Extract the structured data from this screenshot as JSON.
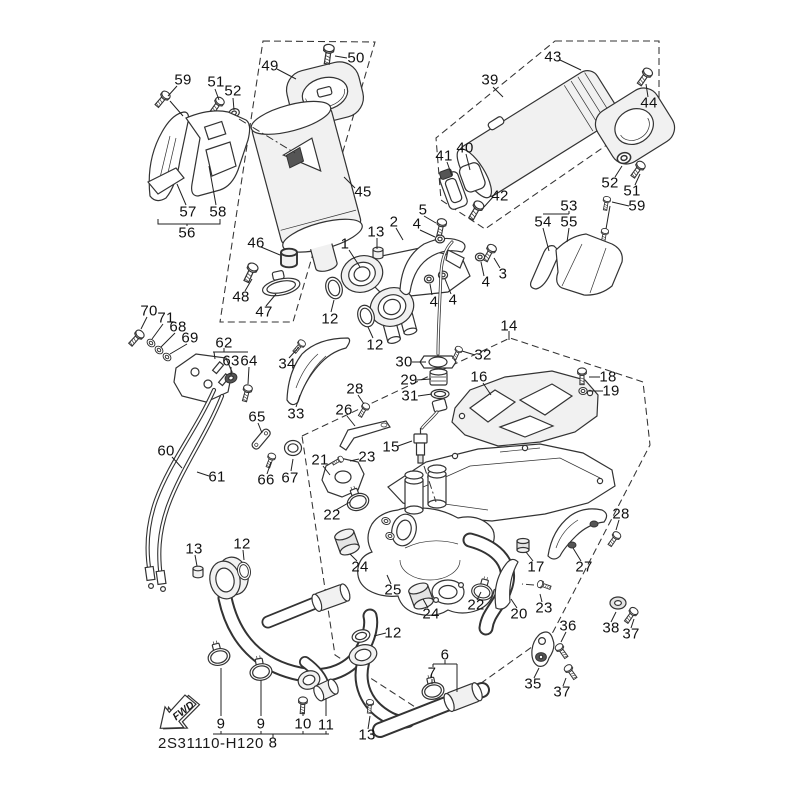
{
  "diagram": {
    "code": "2S31110-H120",
    "fwd_label": "FWD",
    "colors": {
      "line": "#333333",
      "background": "#ffffff",
      "text": "#111111"
    },
    "labels": [
      {
        "t": "59",
        "x": 183,
        "y": 80
      },
      {
        "t": "51",
        "x": 216,
        "y": 82
      },
      {
        "t": "52",
        "x": 233,
        "y": 91
      },
      {
        "t": "49",
        "x": 270,
        "y": 66
      },
      {
        "t": "50",
        "x": 356,
        "y": 58
      },
      {
        "t": "45",
        "x": 363,
        "y": 192
      },
      {
        "t": "57",
        "x": 188,
        "y": 212
      },
      {
        "t": "58",
        "x": 218,
        "y": 212
      },
      {
        "t": "56",
        "x": 187,
        "y": 233
      },
      {
        "t": "46",
        "x": 256,
        "y": 243
      },
      {
        "t": "48",
        "x": 241,
        "y": 297
      },
      {
        "t": "47",
        "x": 264,
        "y": 312
      },
      {
        "t": "43",
        "x": 553,
        "y": 57
      },
      {
        "t": "39",
        "x": 490,
        "y": 80
      },
      {
        "t": "44",
        "x": 649,
        "y": 103
      },
      {
        "t": "40",
        "x": 465,
        "y": 148
      },
      {
        "t": "41",
        "x": 444,
        "y": 156
      },
      {
        "t": "42",
        "x": 500,
        "y": 196
      },
      {
        "t": "52",
        "x": 610,
        "y": 183
      },
      {
        "t": "51",
        "x": 632,
        "y": 191
      },
      {
        "t": "59",
        "x": 637,
        "y": 206
      },
      {
        "t": "53",
        "x": 569,
        "y": 206
      },
      {
        "t": "54",
        "x": 543,
        "y": 222
      },
      {
        "t": "55",
        "x": 569,
        "y": 222
      },
      {
        "t": "1",
        "x": 345,
        "y": 244
      },
      {
        "t": "13",
        "x": 376,
        "y": 232
      },
      {
        "t": "2",
        "x": 394,
        "y": 222
      },
      {
        "t": "5",
        "x": 423,
        "y": 210
      },
      {
        "t": "4",
        "x": 417,
        "y": 224
      },
      {
        "t": "3",
        "x": 503,
        "y": 274
      },
      {
        "t": "4",
        "x": 486,
        "y": 282
      },
      {
        "t": "4",
        "x": 453,
        "y": 300
      },
      {
        "t": "4",
        "x": 434,
        "y": 302
      },
      {
        "t": "12",
        "x": 330,
        "y": 319
      },
      {
        "t": "12",
        "x": 375,
        "y": 345
      },
      {
        "t": "14",
        "x": 509,
        "y": 326
      },
      {
        "t": "70",
        "x": 149,
        "y": 311
      },
      {
        "t": "71",
        "x": 166,
        "y": 318
      },
      {
        "t": "68",
        "x": 178,
        "y": 327
      },
      {
        "t": "69",
        "x": 190,
        "y": 338
      },
      {
        "t": "62",
        "x": 224,
        "y": 343
      },
      {
        "t": "63",
        "x": 231,
        "y": 361
      },
      {
        "t": "64",
        "x": 249,
        "y": 361
      },
      {
        "t": "34",
        "x": 287,
        "y": 364
      },
      {
        "t": "33",
        "x": 296,
        "y": 414
      },
      {
        "t": "60",
        "x": 166,
        "y": 451
      },
      {
        "t": "61",
        "x": 217,
        "y": 477
      },
      {
        "t": "65",
        "x": 257,
        "y": 417
      },
      {
        "t": "66",
        "x": 266,
        "y": 480
      },
      {
        "t": "67",
        "x": 290,
        "y": 478
      },
      {
        "t": "30",
        "x": 404,
        "y": 362
      },
      {
        "t": "32",
        "x": 483,
        "y": 355
      },
      {
        "t": "29",
        "x": 409,
        "y": 380
      },
      {
        "t": "31",
        "x": 410,
        "y": 396
      },
      {
        "t": "16",
        "x": 479,
        "y": 377
      },
      {
        "t": "18",
        "x": 608,
        "y": 377
      },
      {
        "t": "19",
        "x": 611,
        "y": 391
      },
      {
        "t": "15",
        "x": 391,
        "y": 447
      },
      {
        "t": "26",
        "x": 344,
        "y": 410
      },
      {
        "t": "28",
        "x": 355,
        "y": 389
      },
      {
        "t": "23",
        "x": 367,
        "y": 457
      },
      {
        "t": "21",
        "x": 320,
        "y": 460
      },
      {
        "t": "22",
        "x": 332,
        "y": 515
      },
      {
        "t": "24",
        "x": 360,
        "y": 567
      },
      {
        "t": "25",
        "x": 393,
        "y": 590
      },
      {
        "t": "17",
        "x": 536,
        "y": 567
      },
      {
        "t": "27",
        "x": 584,
        "y": 567
      },
      {
        "t": "28",
        "x": 621,
        "y": 514
      },
      {
        "t": "13",
        "x": 194,
        "y": 549
      },
      {
        "t": "12",
        "x": 242,
        "y": 544
      },
      {
        "t": "24",
        "x": 431,
        "y": 614
      },
      {
        "t": "22",
        "x": 476,
        "y": 605
      },
      {
        "t": "20",
        "x": 519,
        "y": 614
      },
      {
        "t": "23",
        "x": 544,
        "y": 608
      },
      {
        "t": "36",
        "x": 568,
        "y": 626
      },
      {
        "t": "38",
        "x": 611,
        "y": 628
      },
      {
        "t": "37",
        "x": 631,
        "y": 634
      },
      {
        "t": "35",
        "x": 533,
        "y": 684
      },
      {
        "t": "37",
        "x": 562,
        "y": 692
      },
      {
        "t": "12",
        "x": 393,
        "y": 633
      },
      {
        "t": "6",
        "x": 445,
        "y": 655
      },
      {
        "t": "7",
        "x": 432,
        "y": 673
      },
      {
        "t": "13",
        "x": 367,
        "y": 735
      },
      {
        "t": "9",
        "x": 221,
        "y": 724
      },
      {
        "t": "9",
        "x": 261,
        "y": 724
      },
      {
        "t": "10",
        "x": 303,
        "y": 724
      },
      {
        "t": "11",
        "x": 326,
        "y": 725
      },
      {
        "t": "8",
        "x": 273,
        "y": 743
      }
    ]
  }
}
